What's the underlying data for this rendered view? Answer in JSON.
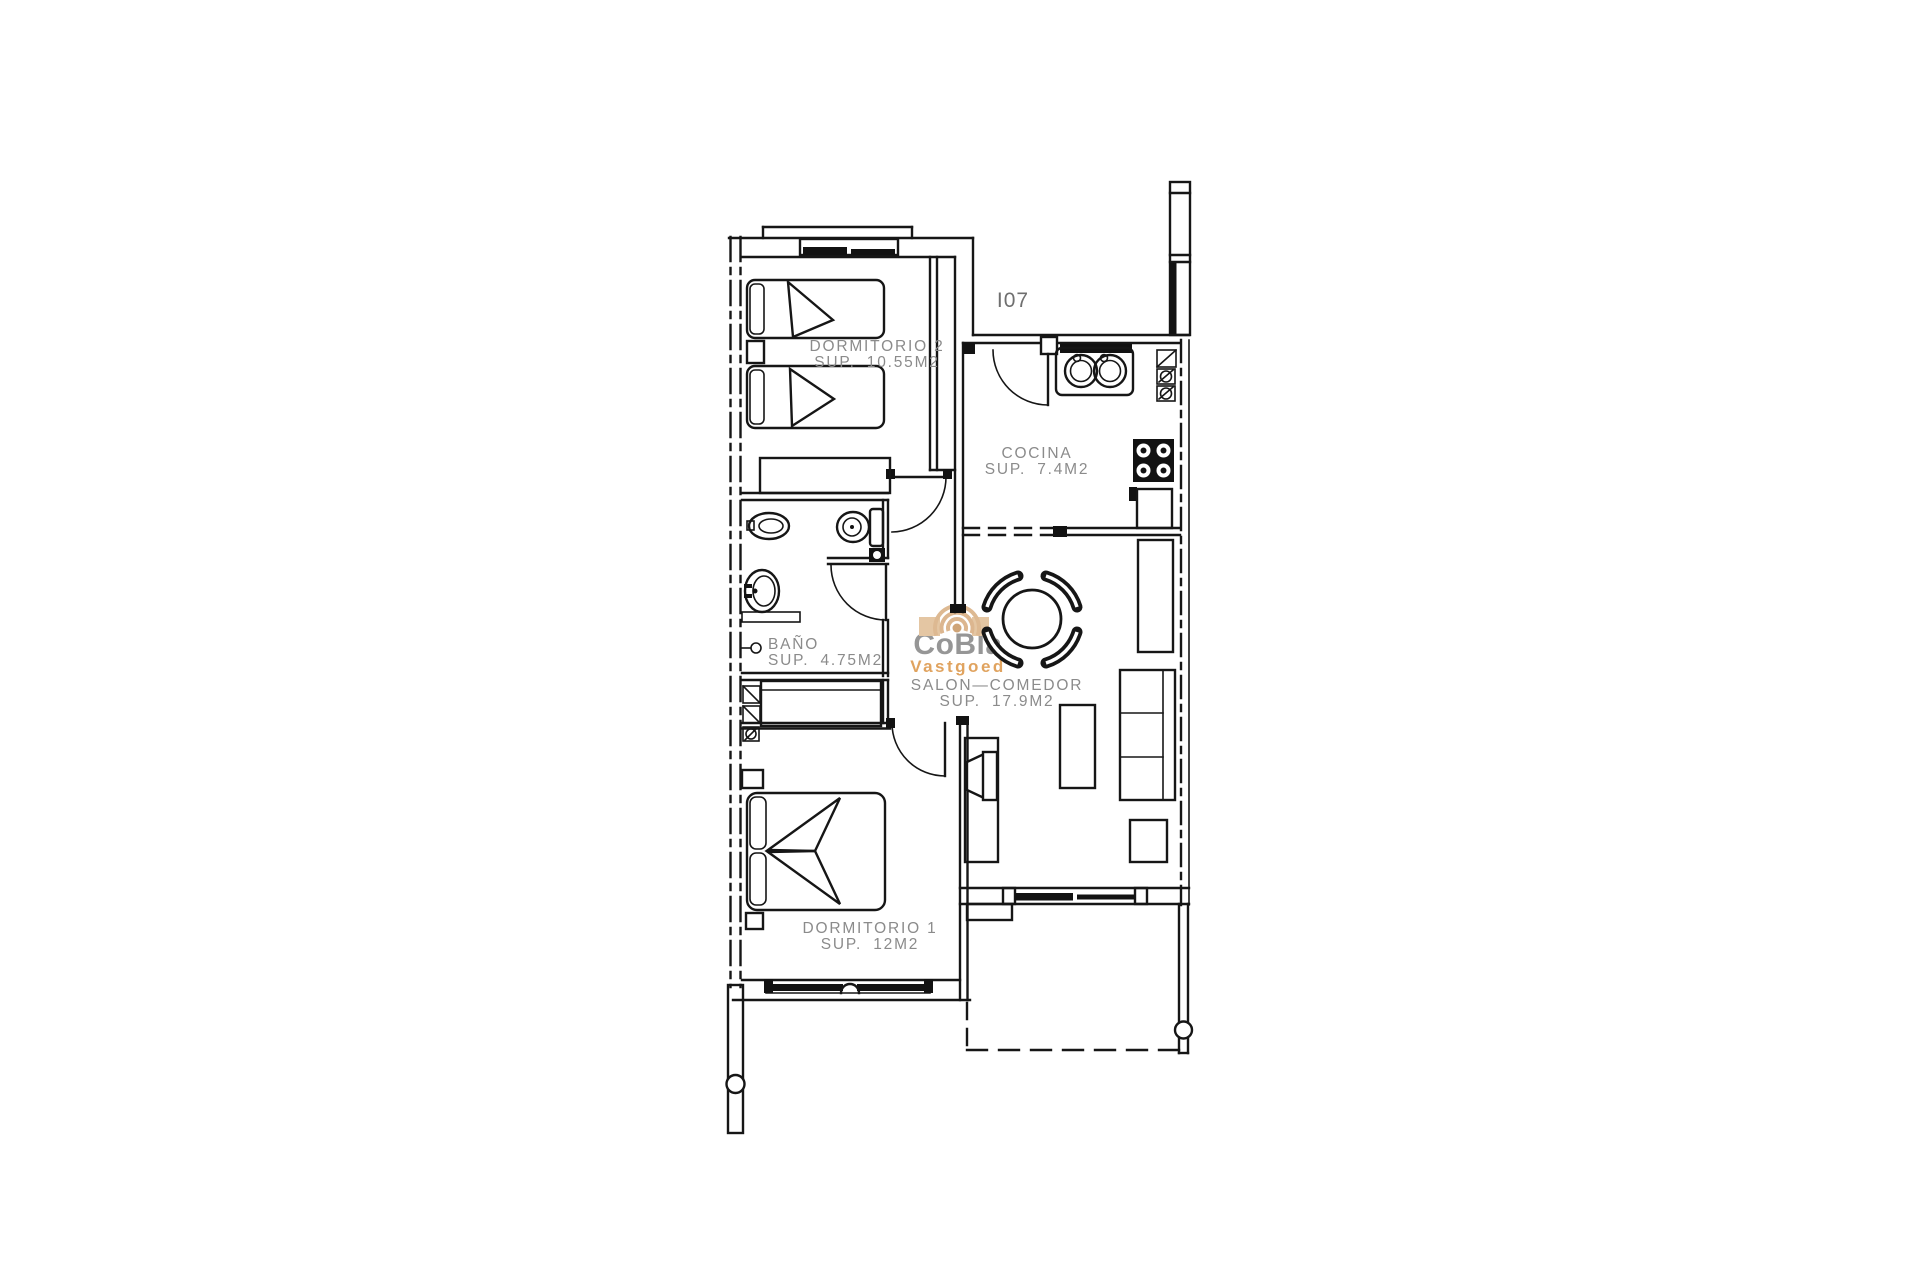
{
  "page": {
    "background": "#ffffff"
  },
  "unit_label": "I07",
  "rooms": [
    {
      "name": "DORMITORIO 2",
      "area": "SUP. 10.55M2"
    },
    {
      "name": "COCINA",
      "area": "SUP. 7.4M2"
    },
    {
      "name": "BAÑO",
      "area": "SUP. 4.75M2"
    },
    {
      "name": "SALON—COMEDOR",
      "area": "SUP. 17.9M2"
    },
    {
      "name": "DORMITORIO 1",
      "area": "SUP. 12M2"
    }
  ],
  "logo": {
    "brand": "CoBla",
    "tagline": "Vastgoed"
  },
  "colors": {
    "wall_line": "#161616",
    "label_text": "#8b8b8b",
    "logo_gray": "#969696",
    "logo_orange": "#e0a35f",
    "logo_tan": "#e4c6a3"
  }
}
